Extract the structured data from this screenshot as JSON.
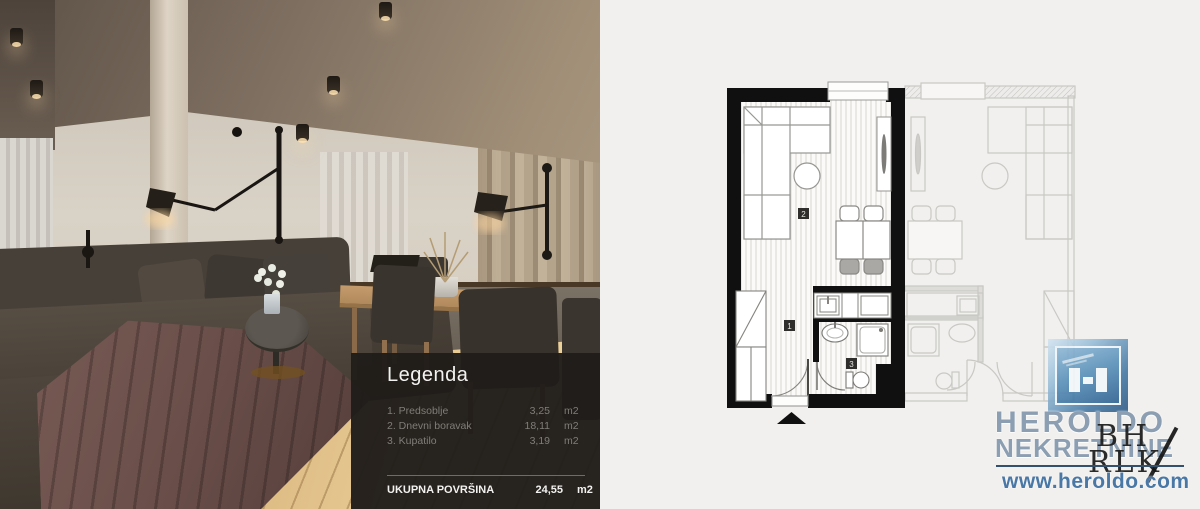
{
  "legend": {
    "title": "Legenda",
    "items": [
      {
        "name": "1. Predsoblje",
        "value": "3,25",
        "unit": "m2"
      },
      {
        "name": "2. Dnevni boravak",
        "value": "18,11",
        "unit": "m2"
      },
      {
        "name": "3. Kupatilo",
        "value": "3,19",
        "unit": "m2"
      }
    ],
    "total_label": "UKUPNA POVRŠINA",
    "total_value": "24,55",
    "total_unit": "m2"
  },
  "floorplan": {
    "room_labels": {
      "hall": "1",
      "living": "2",
      "bath": "3"
    }
  },
  "branding": {
    "name_line1": "HEROLDO",
    "name_line2": "NEKRETNINE",
    "website": "www.heroldo.com",
    "watermark_line1": "BH",
    "watermark_line2": "RLK",
    "colors": {
      "brand_text": "#8c9eb2",
      "link_blue": "#4a78a6",
      "icon_blue": "#2e6292",
      "plan_wall": "#101010"
    }
  }
}
